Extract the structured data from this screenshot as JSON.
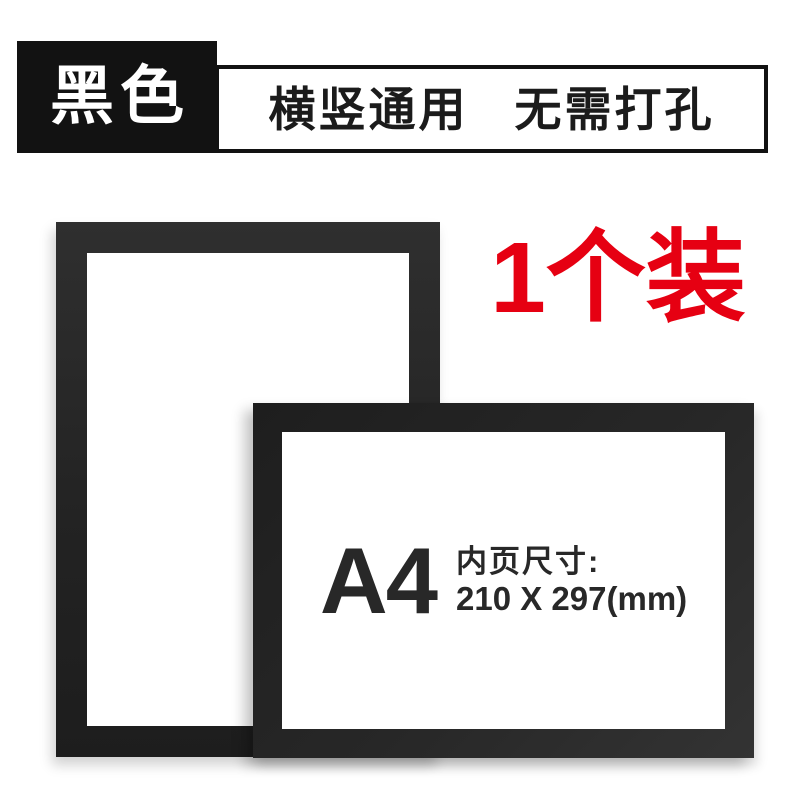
{
  "badge": {
    "label": "黑色",
    "bg_color": "#121212",
    "text_color": "#ffffff"
  },
  "banner": {
    "feature1": "横竖通用",
    "feature2": "无需打孔",
    "border_color": "#121212",
    "text_color": "#1b1b1b"
  },
  "pack": {
    "label": "1个装",
    "color": "#e60012"
  },
  "frames": {
    "frame_color": "#232323",
    "portrait": {
      "orientation": "portrait"
    },
    "landscape": {
      "orientation": "landscape"
    }
  },
  "size_info": {
    "paper_size": "A4",
    "caption": "内页尺寸:",
    "dimensions": "210 X 297(mm)",
    "text_color": "#282828"
  }
}
